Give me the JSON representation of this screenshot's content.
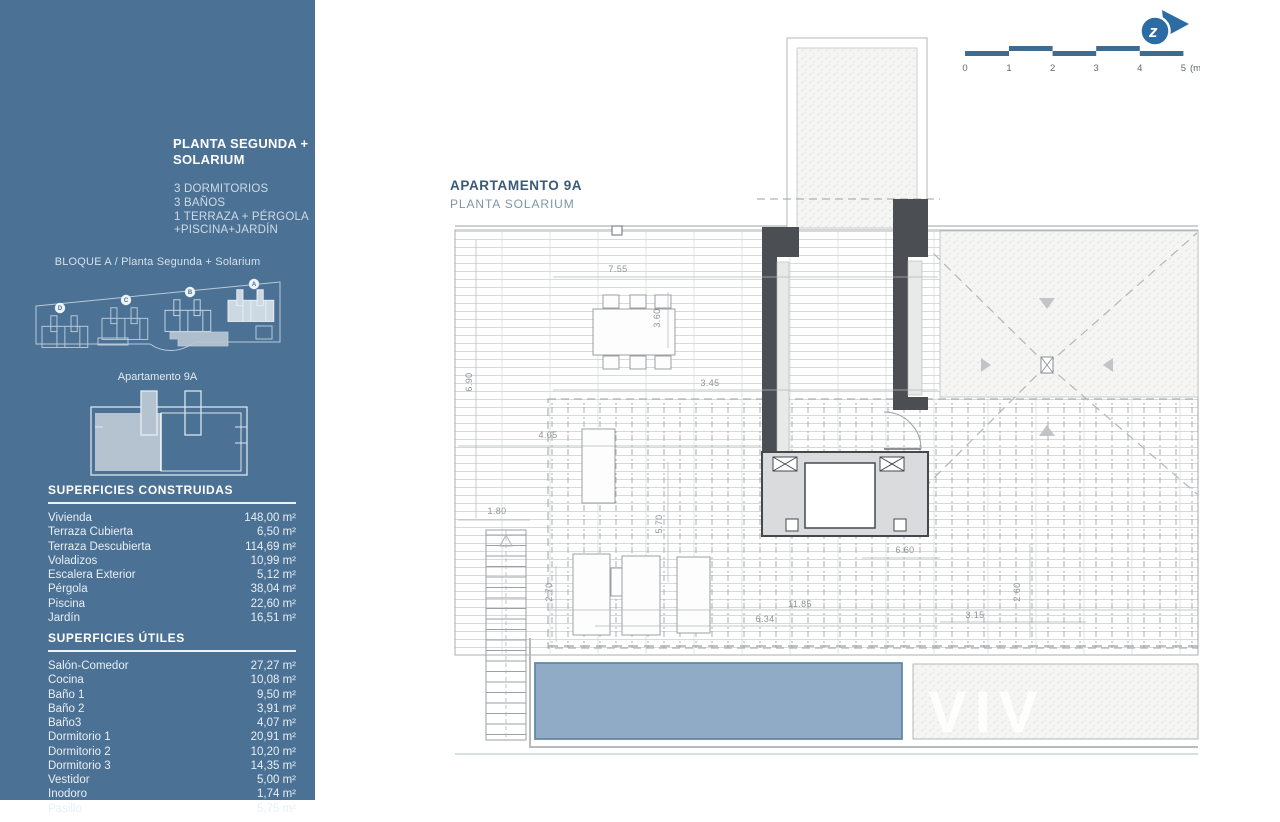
{
  "sidebar": {
    "title_line1": "PLANTA SEGUNDA +",
    "title_line2": "SOLARIUM",
    "features": [
      "3 DORMITORIOS",
      "3 BAÑOS",
      "1 TERRAZA + PÉRGOLA",
      "+PISCINA+JARDÍN"
    ],
    "block_label": "BLOQUE A / Planta Segunda + Solarium",
    "site_badges": [
      "D",
      "C",
      "B",
      "A"
    ],
    "apartment_label": "Apartamento 9A",
    "surfaces_constructed": {
      "heading": "SUPERFICIES CONSTRUIDAS",
      "rows": [
        {
          "label": "Vivienda",
          "value": "148,00 m²"
        },
        {
          "label": "Terraza Cubierta",
          "value": "6,50 m²"
        },
        {
          "label": "Terraza Descubierta",
          "value": "114,69 m²"
        },
        {
          "label": "Voladizos",
          "value": "10,99 m²"
        },
        {
          "label": "Escalera Exterior",
          "value": "5,12 m²"
        },
        {
          "label": "Pérgola",
          "value": "38,04 m²"
        },
        {
          "label": "Piscina",
          "value": "22,60 m²"
        },
        {
          "label": "Jardín",
          "value": "16,51 m²"
        }
      ]
    },
    "surfaces_useful": {
      "heading": "SUPERFICIES ÚTILES",
      "rows": [
        {
          "label": "Salón-Comedor",
          "value": "27,27 m²"
        },
        {
          "label": "Cocina",
          "value": "10,08 m²"
        },
        {
          "label": "Baño 1",
          "value": "9,50 m²"
        },
        {
          "label": "Baño 2",
          "value": "3,91 m²"
        },
        {
          "label": "Baño3",
          "value": "4,07 m²"
        },
        {
          "label": "Dormitorio 1",
          "value": "20,91 m²"
        },
        {
          "label": "Dormitorio 2",
          "value": "10,20 m²"
        },
        {
          "label": "Dormitorio 3",
          "value": "14,35 m²"
        },
        {
          "label": "Vestidor",
          "value": "5,00 m²"
        },
        {
          "label": "Inodoro",
          "value": "1,74 m²"
        },
        {
          "label": "Pasillo",
          "value": "5,75 m²"
        }
      ]
    }
  },
  "plan": {
    "title": "APARTAMENTO 9A",
    "subtitle": "PLANTA SOLARIUM",
    "watermark": "VIV",
    "dims": [
      "7.55",
      "3.60",
      "6.90",
      "3.45",
      "4.05",
      "1.80",
      "5.70",
      "2.70",
      "11.85",
      "6.34",
      "6.60",
      "2.60",
      "3.15"
    ]
  },
  "scale_bar": {
    "ticks": [
      "0",
      "1",
      "2",
      "3",
      "4",
      "5"
    ],
    "unit": "(m)"
  },
  "logo": {
    "letter": "z"
  },
  "colors": {
    "sidebar_bg": "#4B7195",
    "accent_blue": "#2D6CA3",
    "pool": "#8FABC6",
    "title": "#3A5A77"
  }
}
